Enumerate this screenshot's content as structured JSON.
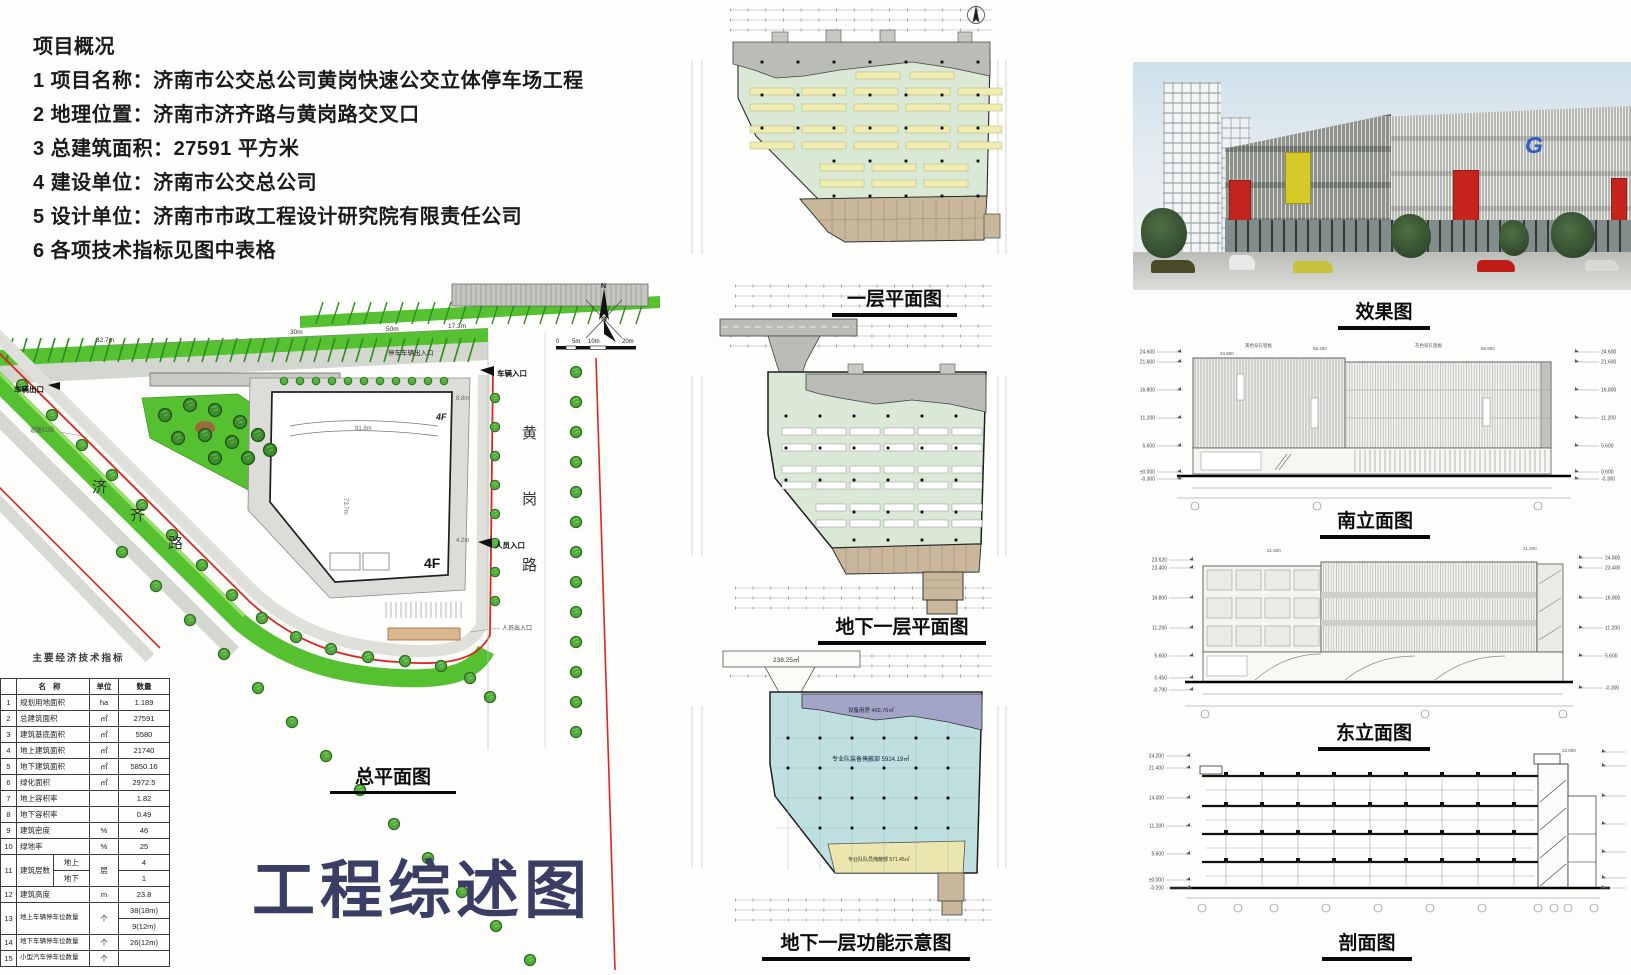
{
  "overview": {
    "title": "项目概况",
    "lines": [
      "1 项目名称：济南市公交总公司黄岗快速公交立体停车场工程",
      "2 地理位置：济南市济齐路与黄岗路交叉口",
      "3 总建筑面积：27591 平方米",
      "4 建设单位：济南市公交总公司",
      "5 设计单位：济南市市政工程设计研究院有限责任公司",
      "6 各项技术指标见图中表格"
    ]
  },
  "main_title": "工程综述图",
  "site_plan": {
    "title": "总平面图",
    "building_label": "4F",
    "north": "N",
    "labels": {
      "road_left": "济齐路",
      "road_right": "黄岗路",
      "vehicle_exit": "车辆出口",
      "vehicle_entrance": "车辆入口",
      "people_entrance": "人员入口",
      "people_access": "人员出入口",
      "red_line": "道路红线",
      "parking_access": "停车车辆出入口"
    },
    "scale": [
      "0",
      "5m",
      "10m",
      "20m"
    ],
    "dims": [
      "32.7m",
      "30m",
      "50m",
      "17.3m",
      "81.8m",
      "4.2m",
      "8.8m",
      "73.7m"
    ]
  },
  "table": {
    "title": "主要经济技术指标",
    "headers": [
      "名称",
      "单位",
      "数量"
    ],
    "rows": [
      {
        "no": "1",
        "name": "规划用地面积",
        "unit": "ha",
        "value": "1.189"
      },
      {
        "no": "2",
        "name": "总建筑面积",
        "unit": "㎡",
        "value": "27591"
      },
      {
        "no": "3",
        "name": "建筑基底面积",
        "unit": "㎡",
        "value": "5580"
      },
      {
        "no": "4",
        "name": "地上建筑面积",
        "unit": "㎡",
        "value": "21740"
      },
      {
        "no": "5",
        "name": "地下建筑面积",
        "unit": "㎡",
        "value": "5850.16"
      },
      {
        "no": "6",
        "name": "绿化面积",
        "unit": "㎡",
        "value": "2972.5"
      },
      {
        "no": "7",
        "name": "地上容积率",
        "unit": "",
        "value": "1.82"
      },
      {
        "no": "8",
        "name": "地下容积率",
        "unit": "",
        "value": "0.49"
      },
      {
        "no": "9",
        "name": "建筑密度",
        "unit": "%",
        "value": "46"
      },
      {
        "no": "10",
        "name": "绿地率",
        "unit": "%",
        "value": "25"
      },
      {
        "no": "11",
        "name": "建筑层数",
        "unit": "层",
        "sub": [
          [
            "地上",
            "4"
          ],
          [
            "地下",
            "1"
          ]
        ]
      },
      {
        "no": "12",
        "name": "建筑高度",
        "unit": "m",
        "value": "23.8"
      },
      {
        "no": "13",
        "name": "地上车辆停车位数量",
        "unit": "个",
        "values": [
          "38(18m)",
          "9(12m)"
        ]
      },
      {
        "no": "14",
        "name": "地下车辆停车位数量",
        "unit": "个",
        "value": "26(12m)"
      },
      {
        "no": "15",
        "name": "小型汽车停车位数量",
        "unit": "个",
        "value": ""
      }
    ]
  },
  "plans": [
    {
      "title": "一层平面图"
    },
    {
      "title": "地下一层平面图"
    },
    {
      "title": "地下一层功能示意图",
      "ramp_area": "238.25㎡",
      "zone_top": "设备用房 469.76㎡",
      "zone_main": "专业队装备掩蔽部 5924.19㎡",
      "zone_bottom": "专业队队员掩蔽部 571.45㎡"
    }
  ],
  "rendering": {
    "title": "效果图",
    "logo": "G"
  },
  "elevations": {
    "south": {
      "title": "南立面图",
      "levels_left": [
        "24.600",
        "21.600",
        "16.800",
        "11.200",
        "5.600",
        "±0.000",
        "-0.300"
      ],
      "levels_right": [
        "24.600",
        "21.600",
        "16.800",
        "11.200",
        "5.600",
        "0.600",
        "-0.300"
      ],
      "annotations": [
        "黄色穿孔铝板",
        "23.800",
        "56.400",
        "灰色穿孔铝板",
        "56.800"
      ]
    },
    "east": {
      "title": "东立面图",
      "levels_left": [
        "23.620",
        "23.400",
        "16.800",
        "11.200",
        "5.600",
        "0.450",
        "-0.790"
      ],
      "levels_right": [
        "24.800",
        "23.400",
        "16.800",
        "11.200",
        "5.600",
        "-0.300"
      ],
      "annotations": [
        "21.600",
        "21.200"
      ]
    },
    "section": {
      "title": "剖面图",
      "levels_left": [
        "24.200",
        "21.400",
        "14.000",
        "11.200",
        "5.600",
        "±0.000",
        "-0.200"
      ],
      "levels_right": [
        "26.400",
        "23.400",
        "16.800",
        "11.200",
        "5.600",
        "0.400",
        "-0.200"
      ],
      "annotations": [
        "23.600"
      ]
    }
  }
}
